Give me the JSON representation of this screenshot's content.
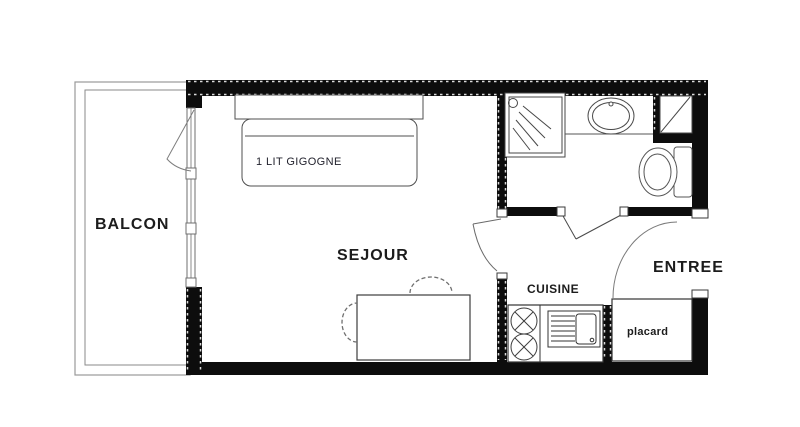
{
  "title": "Studio apartment floor plan",
  "colors": {
    "wall": "#0d0d0d",
    "furniture_line": "#4a4a4a",
    "light_line": "#8a8a8a",
    "text": "#1c1c1c",
    "background": "#ffffff"
  },
  "rooms": {
    "balcony": {
      "label": "BALCON"
    },
    "living": {
      "label": "SEJOUR"
    },
    "entry": {
      "label": "ENTREE"
    },
    "kitchen": {
      "label": "CUISINE"
    },
    "closet": {
      "label": "placard"
    },
    "bed": {
      "label": "1 LIT GIGOGNE"
    }
  },
  "fixtures": [
    "trundle-bed",
    "dining-table",
    "chairs",
    "balcony-french-door",
    "shower",
    "washbasin",
    "toilet",
    "technical-shaft",
    "hob-two-burners",
    "kitchen-sink",
    "closet",
    "entrance-door",
    "bathroom-door"
  ]
}
